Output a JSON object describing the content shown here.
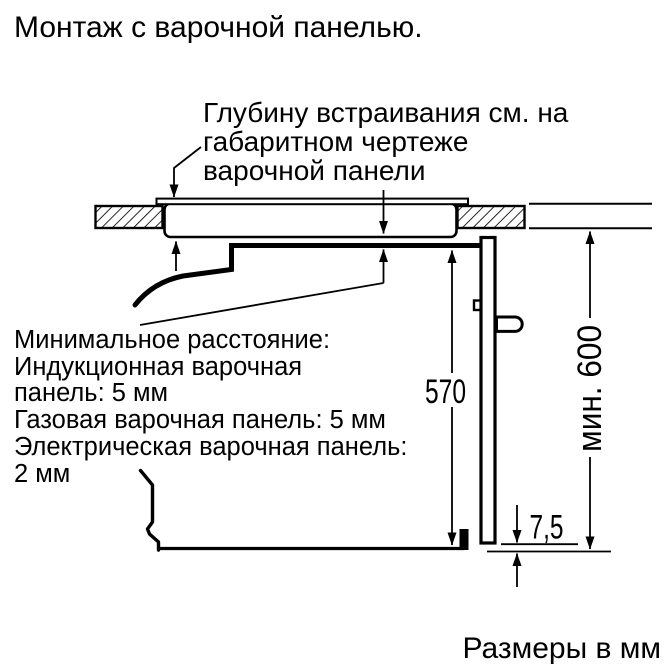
{
  "title": "Монтаж с варочной панелью.",
  "caption": "Размеры в мм",
  "note_hob_depth": {
    "line1": "Глубину встраивания см. на",
    "line2": "габаритном чертеже",
    "line3": "варочной панели"
  },
  "note_min_distance": {
    "line1": "Минимальное расстояние:",
    "line2": "Индукционная варочная",
    "line3": "панель: 5 мм",
    "line4": "Газовая варочная панель: 5 мм",
    "line5": "Электрическая варочная панель:",
    "line6": "2 мм"
  },
  "dimensions": {
    "oven_height": "570",
    "niche_height": "мин. 600",
    "door_bottom_gap": "7,5"
  },
  "colors": {
    "line": "#000000",
    "background": "#ffffff"
  }
}
